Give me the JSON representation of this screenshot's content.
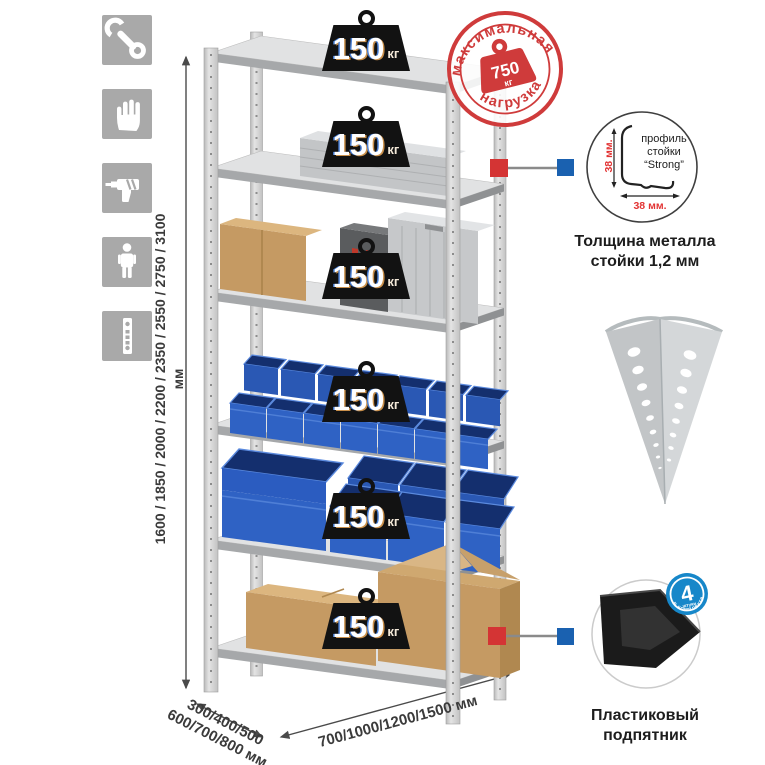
{
  "sidebar": {
    "icons": [
      {
        "name": "wrench-icon"
      },
      {
        "name": "gloves-icon"
      },
      {
        "name": "drill-icon"
      },
      {
        "name": "person-icon"
      },
      {
        "name": "profile-strip-icon"
      }
    ]
  },
  "rack": {
    "shelf_loads": [
      {
        "value": "150",
        "unit": "кг"
      },
      {
        "value": "150",
        "unit": "кг"
      },
      {
        "value": "150",
        "unit": "кг"
      },
      {
        "value": "150",
        "unit": "кг"
      },
      {
        "value": "150",
        "unit": "кг"
      },
      {
        "value": "150",
        "unit": "кг"
      }
    ],
    "max_load_stamp": {
      "arc_top": "максимальная",
      "arc_bottom": "нагрузка",
      "value": "750",
      "unit": "кг"
    }
  },
  "dimensions": {
    "height_label": "1600 / 1850 / 2000 / 2200 / 2350 / 2550 / 2750 / 3100 мм",
    "depth_label_line1": "300/400/500",
    "depth_label_line2": "600/700/800 мм",
    "width_label": "700/1000/1200/1500 мм"
  },
  "details": {
    "profile": {
      "line1": "профиль",
      "line2": "стойки",
      "line3": "“Strong”",
      "dim_vertical": "38 мм.",
      "dim_horizontal": "38 мм.",
      "caption1": "Толщина металла",
      "caption2": "стойки 1,2 мм"
    },
    "foot": {
      "badge_value": "4",
      "badge_sub": "штуки",
      "badge_arc": "в комплекте",
      "caption1": "Пластиковый",
      "caption2": "подпятник"
    }
  },
  "colors": {
    "stamp_red": "#cf3b3b",
    "marker_red": "#d43434",
    "marker_blue": "#1a61b0",
    "badge_blue": "#1787c9",
    "bin_blue": "#2e62c4",
    "icon_gray": "#a9a9a9"
  }
}
